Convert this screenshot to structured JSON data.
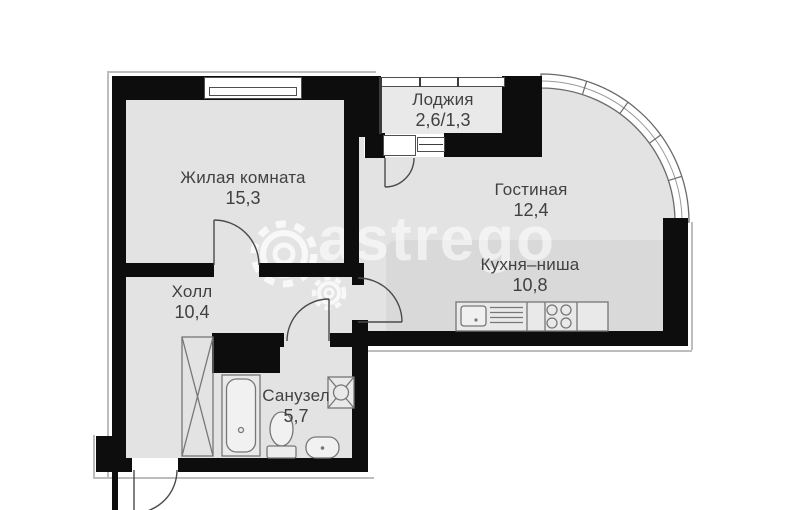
{
  "plan_title": "apartment-floor-plan",
  "rooms": [
    {
      "id": "zhilaya",
      "name": "Жилая комната",
      "area": "15,3"
    },
    {
      "id": "loggia",
      "name": "Лоджия",
      "area": "2,6/1,3"
    },
    {
      "id": "gostinaya",
      "name": "Гостиная",
      "area": "12,4"
    },
    {
      "id": "kitchen",
      "name": "Кухня–ниша",
      "area": "10,8"
    },
    {
      "id": "hall",
      "name": "Холл",
      "area": "10,4"
    },
    {
      "id": "sanuzel",
      "name": "Санузел",
      "area": "5,7"
    }
  ],
  "watermark": {
    "text": "astrego",
    "gear_icon": "gear-icon"
  },
  "fixtures": [
    "bathtub",
    "toilet",
    "wash-basin",
    "washing-machine",
    "wardrobe",
    "kitchen-sink",
    "cooktop",
    "kitchen-counter"
  ],
  "colors": {
    "wall": "#0d0d0d",
    "floor": "#e3e3e3",
    "kitchen_niche_floor": "#d9d9d9",
    "loggia_floor": "#e9e9e9",
    "label_text": "#414141",
    "watermark": "rgba(255,255,255,0.58)"
  }
}
